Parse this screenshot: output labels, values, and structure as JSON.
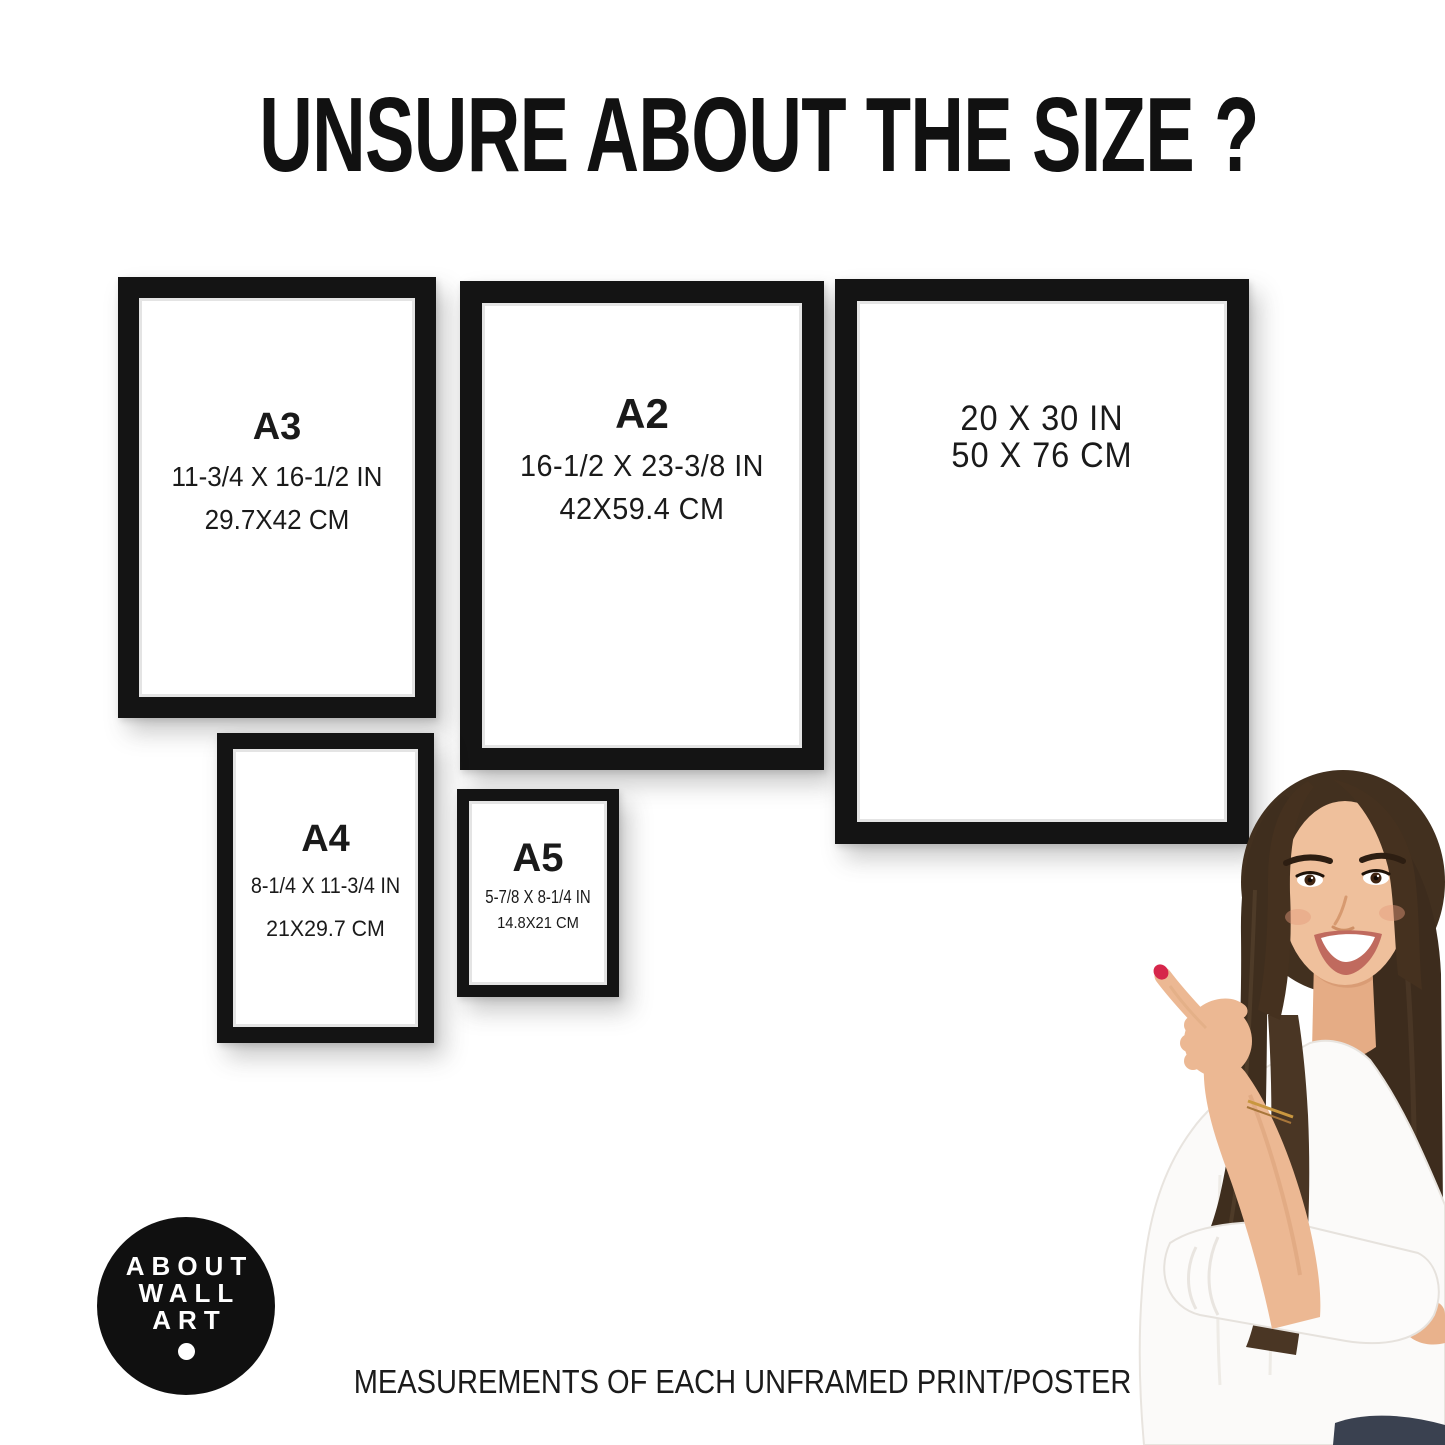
{
  "page": {
    "title": "UNSURE ABOUT THE SIZE ?",
    "footer": "MEASUREMENTS OF EACH UNFRAMED PRINT/POSTER"
  },
  "frames": [
    {
      "name": "A3",
      "label": "A3",
      "size_in": "11-3/4 X 16-1/2 IN",
      "size_cm": "29.7X42 CM"
    },
    {
      "name": "A2",
      "label": "A2",
      "size_in": "16-1/2 X 23-3/8 IN",
      "size_cm": "42X59.4 CM"
    },
    {
      "name": "20x30",
      "size_in": "20 X 30 IN",
      "size_cm": "50 X 76 CM"
    },
    {
      "name": "A4",
      "label": "A4",
      "size_in": "8-1/4 X 11-3/4 IN",
      "size_cm": "21X29.7 CM"
    },
    {
      "name": "A5",
      "label": "A5",
      "size_in": "5-7/8 X 8-1/4 IN",
      "size_cm": "14.8X21 CM"
    }
  ],
  "logo": {
    "lines": [
      "ABOUT",
      "WALL",
      "ART"
    ]
  },
  "colors": {
    "background": "#ffffff",
    "frame_black": "#141414",
    "text": "#1a1a1a",
    "logo_bg": "#101010",
    "nail_red": "#d6264a"
  }
}
